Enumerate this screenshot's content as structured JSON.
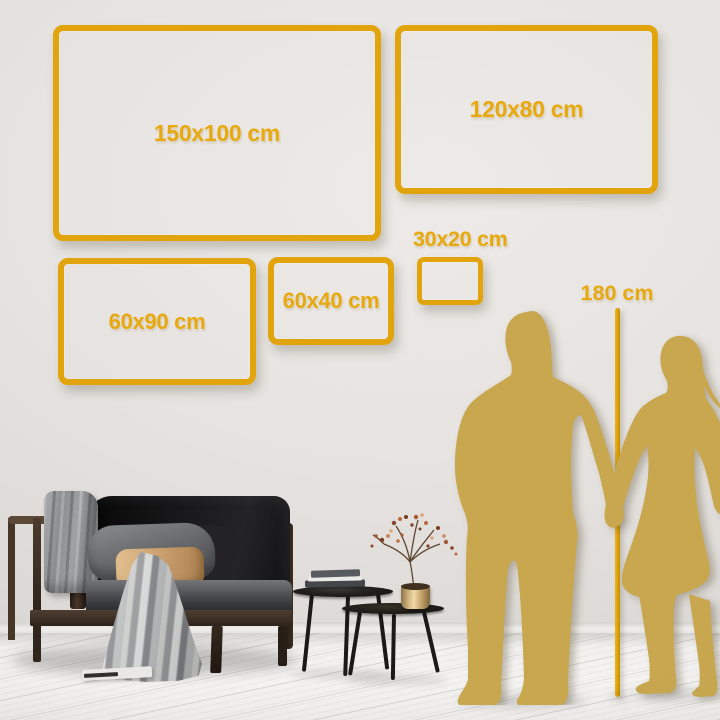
{
  "frames": [
    {
      "id": "150x100",
      "label": "150x100 cm"
    },
    {
      "id": "120x80",
      "label": "120x80 cm"
    },
    {
      "id": "60x90",
      "label": "60x90 cm"
    },
    {
      "id": "60x40",
      "label": "60x40 cm"
    },
    {
      "id": "30x20",
      "label": "30x20 cm"
    }
  ],
  "ruler": {
    "label": "180 cm"
  },
  "colors": {
    "frame_gold": "#e2a40d",
    "label_gold": "#e8a90f",
    "ruler_gold": "#dfa104",
    "silhouette_gold": "#c8a74f"
  }
}
